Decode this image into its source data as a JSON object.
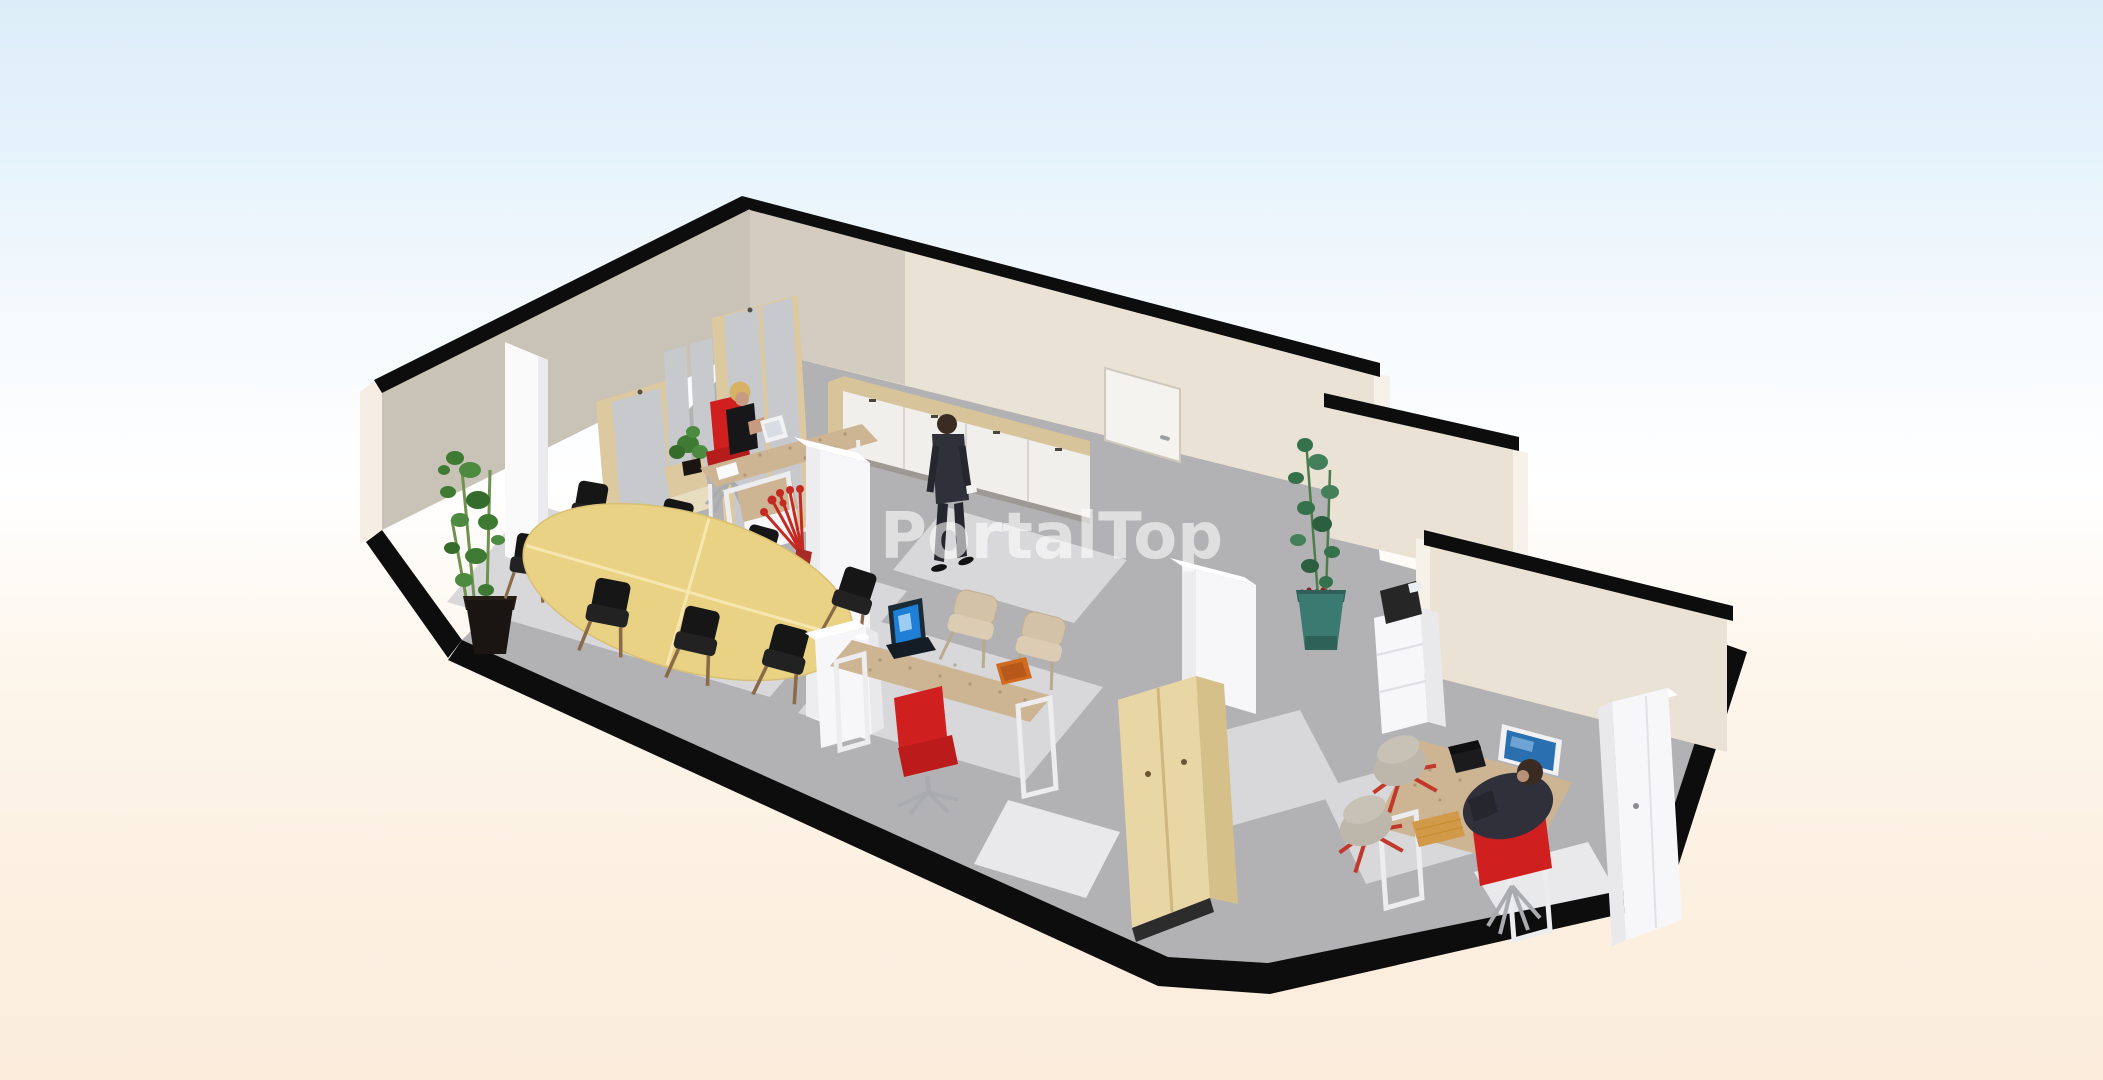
{
  "watermark": {
    "text": "PortalTop",
    "color": "#ffffff",
    "opacity": 0.58
  },
  "scene": {
    "type": "3d-floor-plan-render",
    "people": [
      {
        "id": "receptionist",
        "label": "woman seated at reception desk on red chair"
      },
      {
        "id": "walking-man",
        "label": "man in dark suit walking through open space"
      },
      {
        "id": "seated-man",
        "label": "man in dark suit working at desk in private office"
      }
    ],
    "areas": [
      {
        "id": "meeting-area",
        "objects": [
          "oval-meeting-table",
          "black-chairs-x8",
          "bamboo-plant",
          "wall-column"
        ]
      },
      {
        "id": "reception-open-space",
        "objects": [
          "tall-storage-cabinets",
          "pinboard-panels",
          "reception-desk",
          "privacy-screen",
          "sideboard",
          "interior-door",
          "white-pillar",
          "red-floor-bouquet",
          "laptop-desk",
          "red-office-chair",
          "visitor-chairs-x2",
          "white-low-cabinet",
          "waste-bin",
          "pine-wardrobe"
        ]
      },
      {
        "id": "hallway",
        "objects": [
          "bamboo-plant-teal-pot",
          "printer-cabinet"
        ]
      },
      {
        "id": "private-office",
        "objects": [
          "desk-with-monitor",
          "red-desk-chair",
          "grey-shell-chairs-x2",
          "tall-white-cabinet",
          "keyboard",
          "telephone"
        ]
      }
    ]
  },
  "colors": {
    "bg_top": "#dcedf9",
    "bg_mid": "#ffffff",
    "bg_bottom": "#fbecdc",
    "wall_cap": "#0d0d0d",
    "wall_cream": "#eae2d5",
    "wall_dark": "#c9c2b6",
    "wall_shade": "#d4ccc0",
    "wall_end": "#f6f1e9",
    "wall_outer": "#f6eee4",
    "floor": "#b2b2b4",
    "floor_edge": "#0d0d0d",
    "rug": "#d8d8da",
    "rug_light": "#e9e9eb",
    "door": "#f5f3f0",
    "wood_frame": "#dcc9a0",
    "cabinet_panel": "#c7c9cd",
    "sideboard_top": "#d8c49a",
    "sideboard_door": "#f1efec",
    "wood_desk": "#cdb493",
    "wood_table": "#e9d283",
    "wood_pine": "#e8d6a4",
    "wood_pine_dark": "#d6c089",
    "white_furniture": "#f7f7f9",
    "white_shade": "#e9e9ec",
    "white_frame": "#ededef",
    "red": "#c52a22",
    "red_chair": "#cf1f1f",
    "green": "#3f7a33",
    "green_dark": "#35714b",
    "pot_black": "#1a1512",
    "pot_teal": "#3b7a70",
    "berry": "#8c1f1f",
    "blue_screen": "#1d7fd6",
    "blue_monitor": "#2a6fb0",
    "suit": "#30303a",
    "suit_dark": "#26262e",
    "skin": "#c79b7f",
    "hair_blonde": "#d8b264",
    "hair_dark": "#3a2c22",
    "black_top": "#17171a",
    "chair_black": "#161616",
    "chair_tan": "#d3c1a8",
    "chair_gray": "#bcb6ab",
    "chrome": "#a9abaf",
    "printer": "#262626",
    "tray_orange": "#d06a1e",
    "keyboard_tan": "#d29a48"
  }
}
